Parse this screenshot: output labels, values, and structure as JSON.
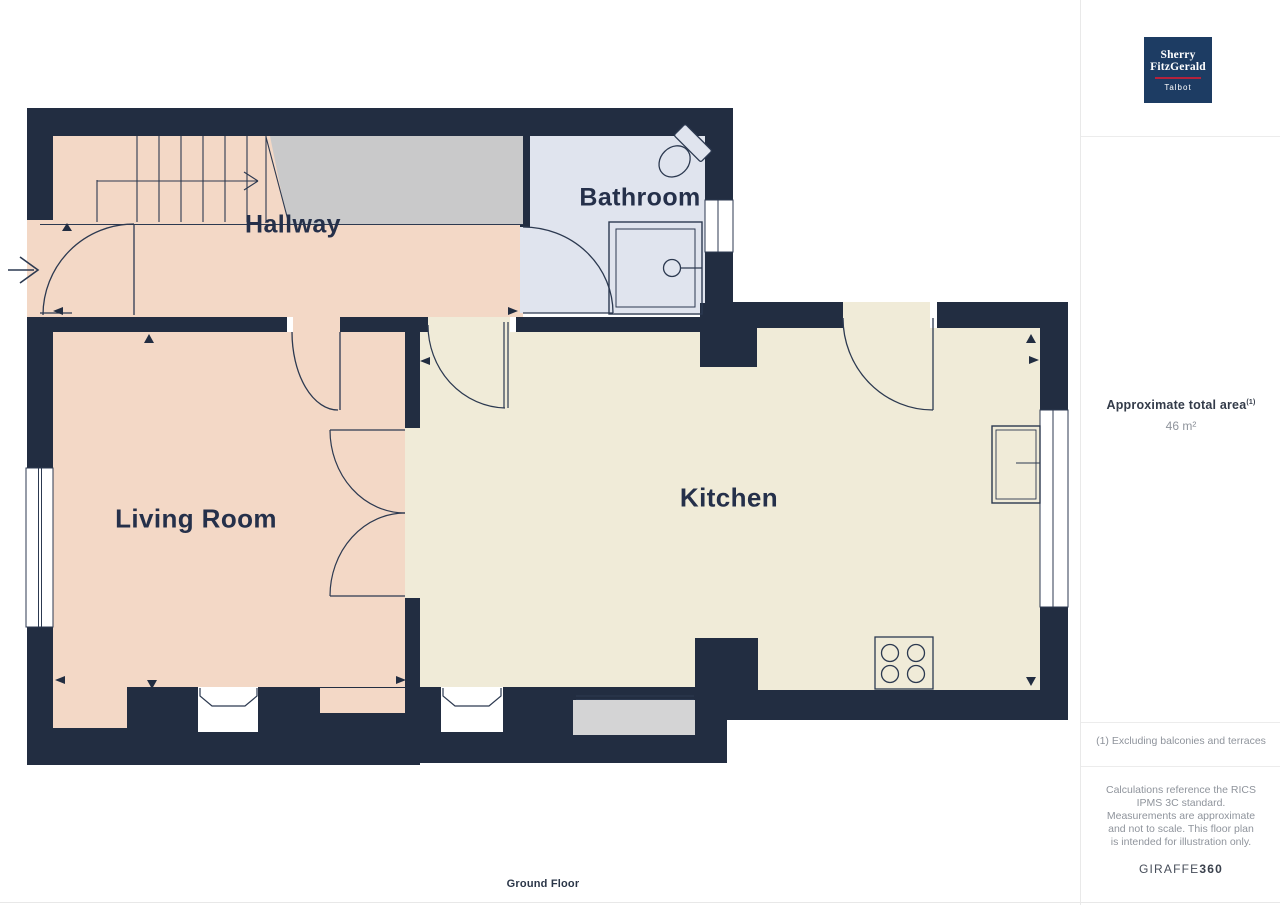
{
  "plan": {
    "rooms": [
      {
        "name": "Hallway"
      },
      {
        "name": "Bathroom"
      },
      {
        "name": "Living Room"
      },
      {
        "name": "Kitchen"
      }
    ],
    "floor_label": "Ground Floor",
    "fixture_icons": [
      "stairs",
      "entry-arrow",
      "front-door",
      "interior-doors",
      "double-doors",
      "shower",
      "toilet",
      "stove",
      "sink",
      "windows",
      "bay-windows",
      "patio-step"
    ]
  },
  "sidebar": {
    "logo": {
      "line1": "Sherry",
      "line2": "FitzGerald",
      "subtitle": "Talbot"
    },
    "area_title": "Approximate total area",
    "area_superscript": "(1)",
    "area_value": "46 m²",
    "footnote": "(1) Excluding balconies and terraces",
    "disclaimer": "Calculations reference the RICS IPMS 3C standard. Measurements are approximate and not to scale. This floor plan is intended for illustration only.",
    "brand_name": "GIRAFFE",
    "brand_suffix": "360"
  },
  "colors": {
    "wall": "#222d41",
    "line": "#2c3950",
    "hallway_floor": "#f3d8c6",
    "kitchen_floor": "#f0ebd8",
    "bathroom_floor": "#e0e4ee",
    "landing_gray": "#c9c9ca",
    "step_gray": "#d4d4d5",
    "logo_navy": "#1d3c63",
    "logo_red": "#b5223c",
    "heading_text": "#333b49",
    "muted_text": "#8f949c"
  }
}
